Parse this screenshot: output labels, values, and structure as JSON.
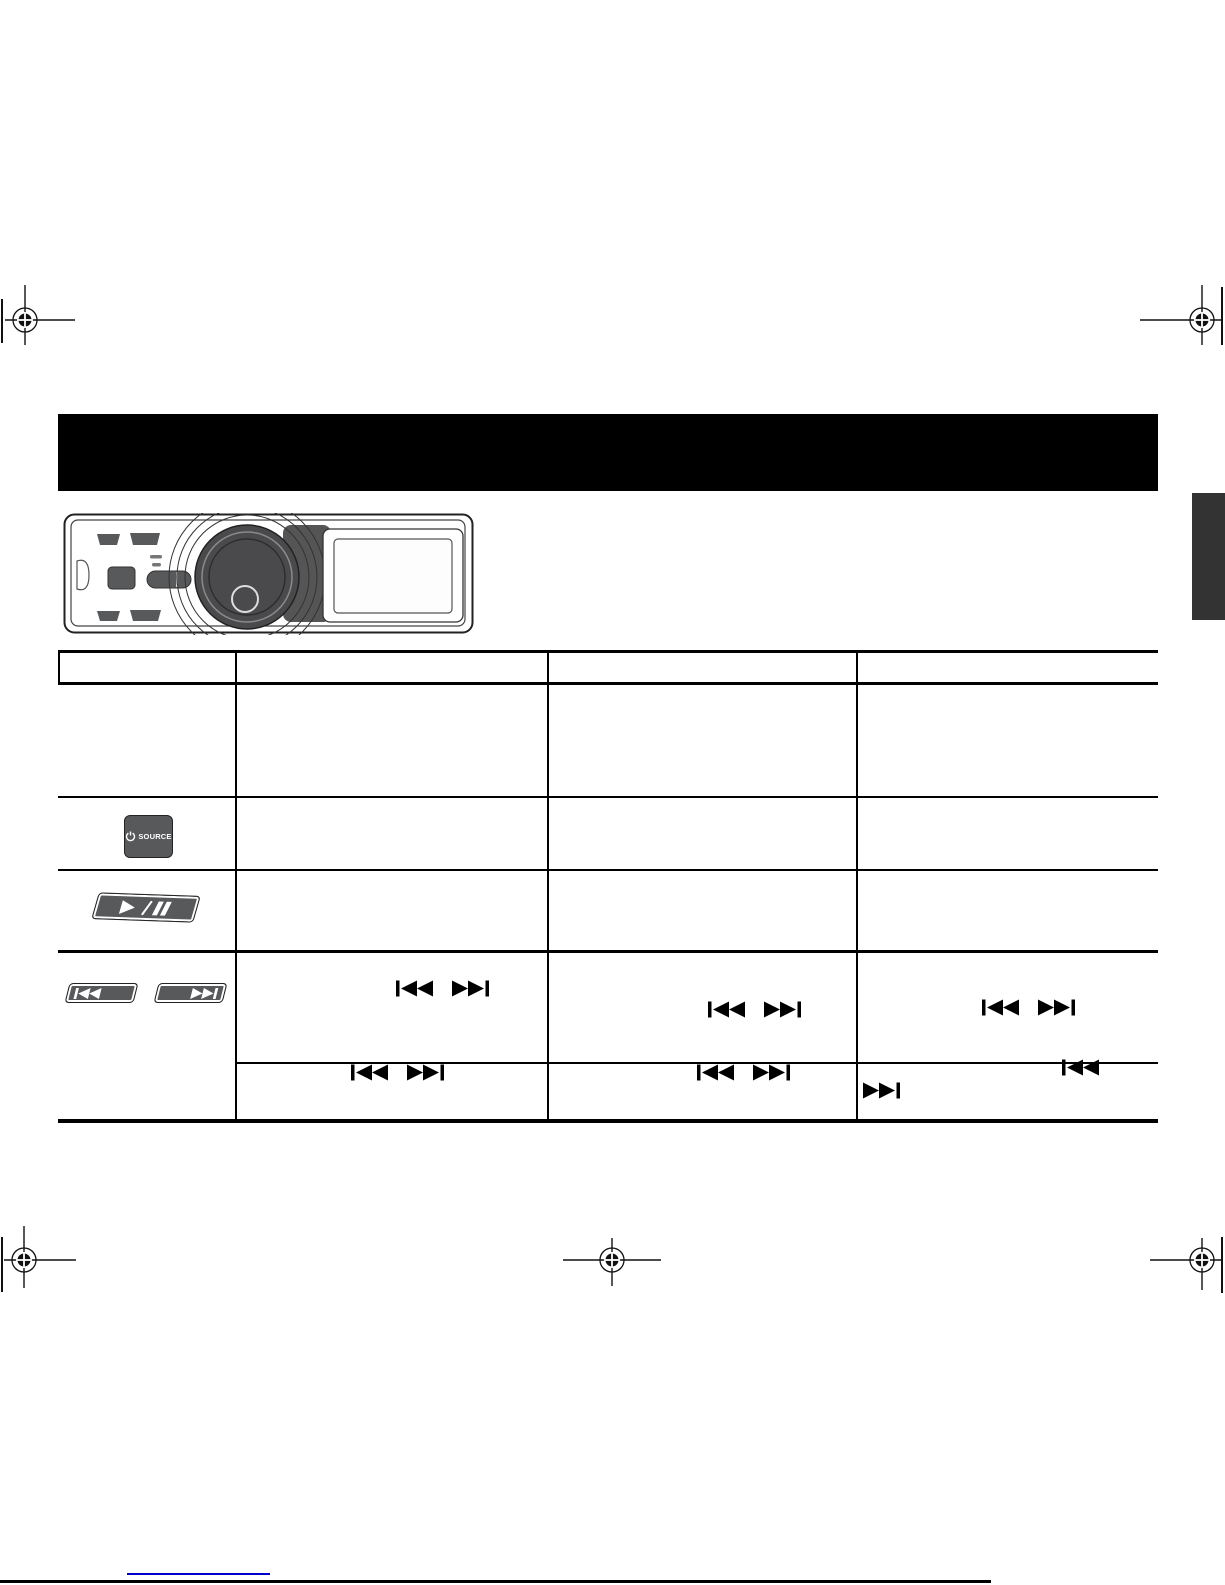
{
  "document": {
    "kind": "scanned car-stereo instruction manual page",
    "banner_title": "",
    "side_tab_label": ""
  },
  "colors": {
    "banner_black": "#000000",
    "button_gray": "#58595b",
    "knob_gray": "#4a4a4c",
    "side_tab_gray": "#333333",
    "bottom_link_blue": "#0000cc",
    "glyph_black": "#000000"
  },
  "device": {
    "name": "car stereo front panel illustration",
    "parts": [
      "faceplate",
      "volume-knob",
      "display-window",
      "source-button",
      "pill-button",
      "corner-buttons"
    ]
  },
  "controls": {
    "source_button": {
      "label": "SOURCE",
      "icon": "power-icon"
    },
    "play_pause_button": {
      "icons": [
        "play-icon",
        "pause-icon"
      ],
      "separator": "/"
    },
    "seek_buttons": {
      "icons": [
        "previous-track-icon",
        "next-track-icon"
      ]
    }
  },
  "table": {
    "column_headers": [
      "",
      "",
      "",
      ""
    ],
    "rows": [
      {
        "name": "row-general",
        "control": "",
        "cells": [
          "",
          "",
          ""
        ]
      },
      {
        "name": "row-source-button",
        "control": "source-button",
        "cells": [
          "",
          "",
          ""
        ]
      },
      {
        "name": "row-play-pause-button",
        "control": "play-pause-button",
        "cells": [
          "",
          "",
          ""
        ]
      },
      {
        "name": "row-seek-buttons",
        "control": "previous-next-buttons",
        "sub_rows": [
          {
            "cells": [
              "|◄◄  ►►|",
              "|◄◄  ►►|",
              "|◄◄  ►►|"
            ]
          },
          {
            "cells": [
              "|◄◄  ►►|",
              "|◄◄  ►►|",
              "|◄◄ … ►►|"
            ]
          }
        ]
      }
    ]
  }
}
